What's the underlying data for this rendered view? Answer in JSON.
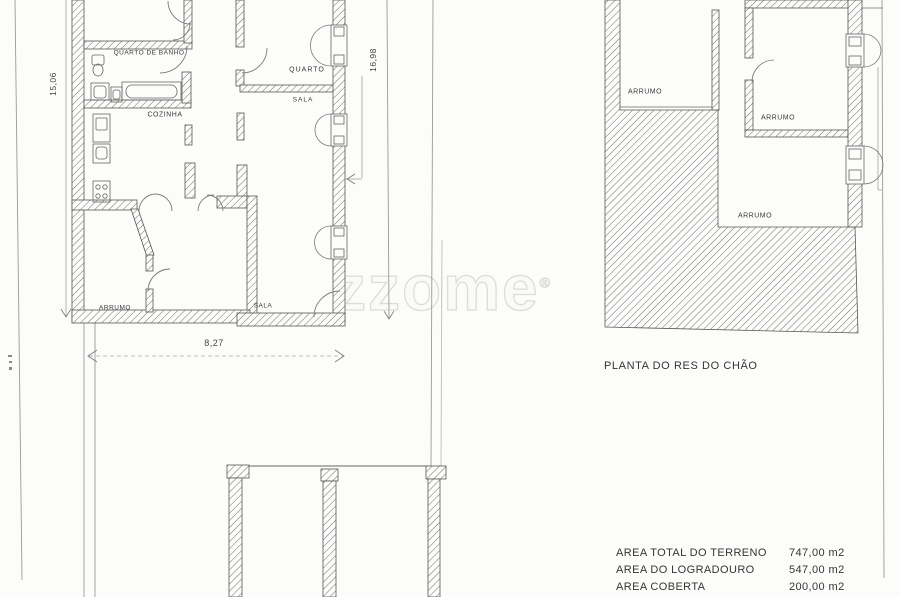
{
  "watermark": {
    "text": "zzome",
    "reg": "®"
  },
  "plan_left": {
    "rooms": [
      {
        "label": "QUARTO DE BANHO"
      },
      {
        "label": "COZINHA"
      },
      {
        "label": "QUARTO"
      },
      {
        "label": "SALA"
      },
      {
        "label": "ARRUMO"
      },
      {
        "label": "SALA"
      }
    ],
    "dimensions": {
      "left": "15,06",
      "right": "16,98",
      "bottom": "8,27"
    }
  },
  "plan_right": {
    "title": "PLANTA DO RES DO CHÃO",
    "rooms": [
      {
        "label": "ARRUMO"
      },
      {
        "label": "ARRUMO"
      },
      {
        "label": "ARRUMO"
      }
    ]
  },
  "area_table": {
    "rows": [
      {
        "label": "AREA TOTAL DO TERRENO",
        "value": "747,00 m2"
      },
      {
        "label": "AREA DO LOGRADOURO",
        "value": "547,00 m2"
      },
      {
        "label": "AREA COBERTA",
        "value": "200,00 m2"
      }
    ]
  }
}
